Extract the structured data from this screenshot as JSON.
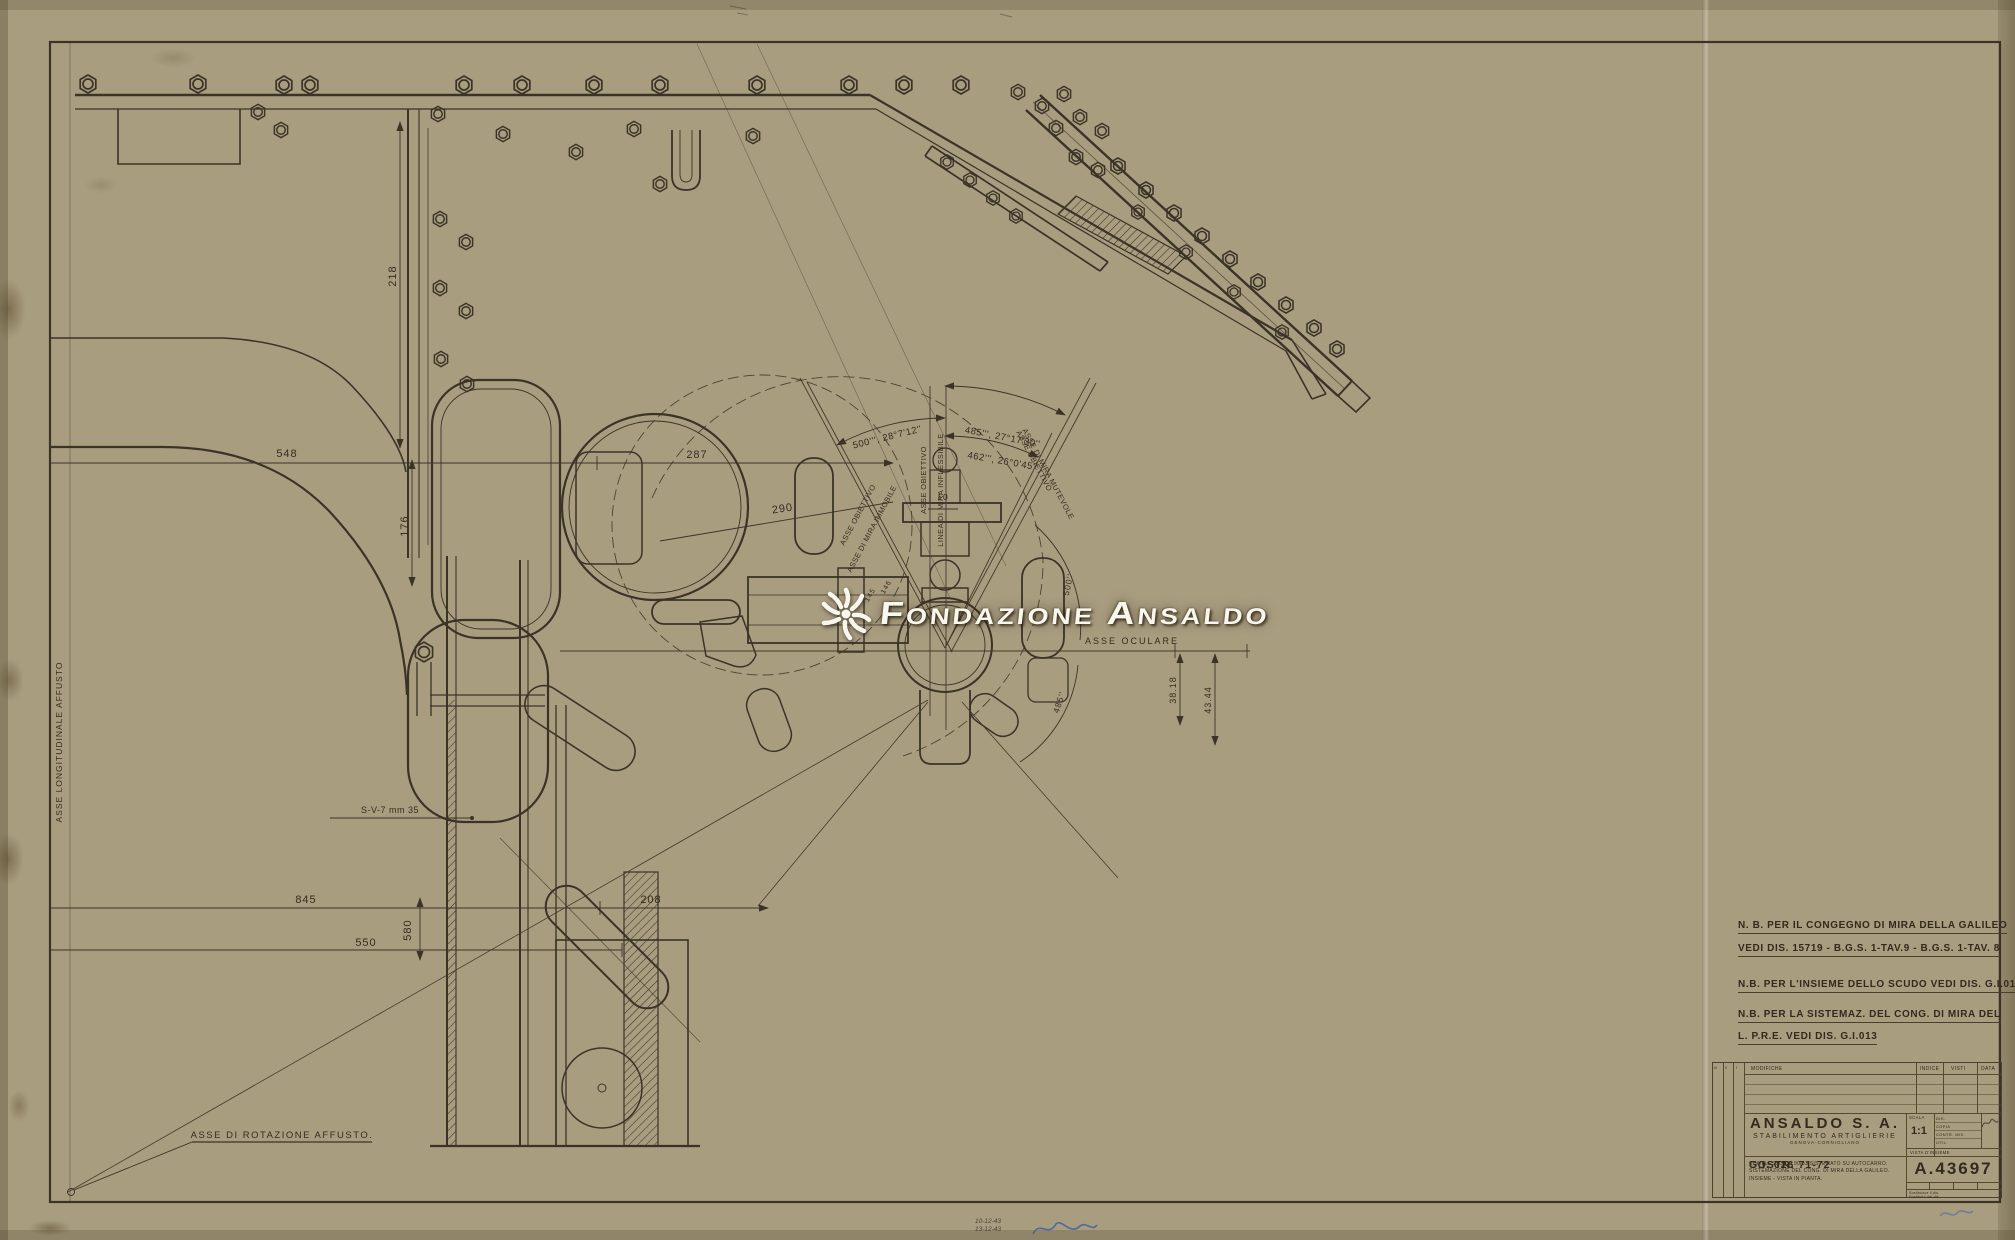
{
  "palette": {
    "paper": "#c7bc9e",
    "ink": "#3a3326",
    "watermark": "#f8f6ed",
    "signature_blue": "#3d5fa8"
  },
  "watermark": {
    "text": "Fondazione Ansaldo"
  },
  "notes": [
    "N. B. PER IL CONGEGNO DI MIRA DELLA GALILEO",
    "VEDI DIS. 15719 - B.G.S. 1-TAV.9 - B.G.S. 1-TAV. 8",
    "N.B. PER L'INSIEME DELLO SCUDO VEDI DIS. G.I.012",
    "N.B. PER LA SISTEMAZ. DEL CONG. DI MIRA DEL",
    "L. P.R.E. VEDI DIS. G.I.013"
  ],
  "labels": [
    "548",
    "287",
    "290",
    "218",
    "176",
    "845",
    "550",
    "580",
    "208",
    "S-V-7 mm 35",
    "ASSE DI ROTAZIONE AFFUSTO.",
    "ASSE LONGITUDINALE AFFUSTO",
    "500''', 28°7'12''",
    "485''', 27°17'30''",
    "462''', 26°0'45''",
    "ASSE OBIETTIVO",
    "LINEA DI MIRA INFLESSIBILE",
    "ASSE OBIETTIVO",
    "ASSE DI MIRA IMMOBILE",
    "ASSE OBIETTIVO",
    "ASSE DI MIRA MUTEVOLE",
    "ASSE OCULARE",
    "38.18",
    "43.44",
    "500''",
    "485''",
    "10",
    "145",
    "146"
  ],
  "title_block": {
    "mod_cols": [
      "III",
      "II",
      "I"
    ],
    "modifiche": "MODIFICHE",
    "indice": "INDICE",
    "visti": "VISTI",
    "data": "DATA",
    "company": "ANSALDO S. A.",
    "division": "STABILIMENTO ARTIGLIERIE",
    "city": "GENOVA-CORNIGLIANO",
    "costr": "COSTR. 71-72",
    "gi": "G.I. 026",
    "desc1": "COMPLESSO DA 90/53 SISTEMATO SU AUTOCARRO.",
    "desc2": "SISTEMAZIONE DEL CONG. DI MIRA DELLA GALILEO.",
    "desc3": "INSIEME - VISTA IN PIANTA.",
    "scala_label": "SCALA",
    "scala_value": "1:1",
    "rows": [
      "DIS.",
      "COPIA",
      "CONTR. MIS.",
      "UTIL."
    ],
    "vista": "VISTA D'INSIEME",
    "number": "A.43697",
    "sost1": "Sostituisce il dis.",
    "sost2": "Sostituito dal dis."
  },
  "handwritten": {
    "date1": "10-12-43",
    "date2": "13-12-43"
  }
}
